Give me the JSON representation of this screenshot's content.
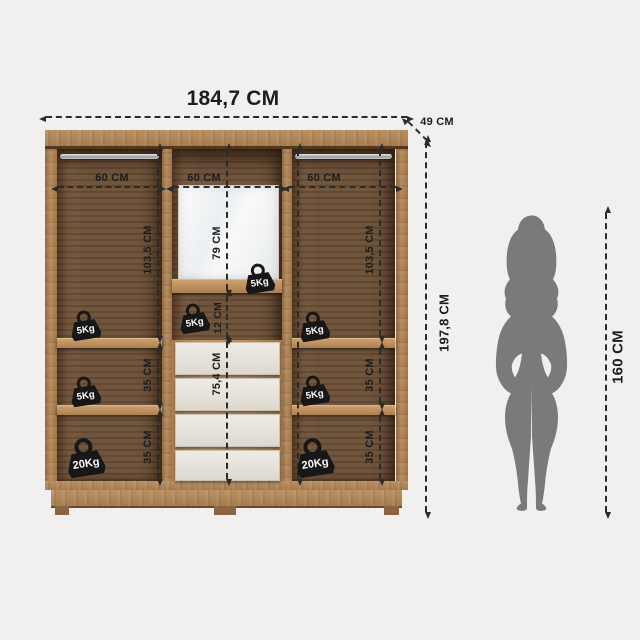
{
  "overall": {
    "width_label": "184,7 CM",
    "depth_label": "49 CM",
    "height_label": "197,8 CM",
    "person_height_label": "160 CM"
  },
  "sections": {
    "left": {
      "width_label": "60 CM",
      "top_height_label": "103,5 CM",
      "mid_height_label": "35 CM",
      "bottom_height_label": "35 CM",
      "badge_top": "5Kg",
      "badge_mid": "5Kg",
      "badge_bottom": "20Kg"
    },
    "middle": {
      "width_label": "60 CM",
      "mirror_height_label": "79 CM",
      "badge_mirror": "5Kg",
      "gap_height_label": "12 CM",
      "badge_gap": "5Kg",
      "drawers_height_label": "75,4 CM",
      "drawer_count": 4
    },
    "right": {
      "width_label": "60 CM",
      "top_height_label": "103,5 CM",
      "mid_height_label": "35 CM",
      "bottom_height_label": "35 CM",
      "badge_top": "5Kg",
      "badge_mid": "5Kg",
      "badge_bottom": "20Kg"
    }
  },
  "colors": {
    "background": "#f2f0ee",
    "wood": "#b2885a",
    "wood_dark": "#6c5037",
    "dimension_line": "#2b2b2b",
    "badge": "#171717",
    "badge_text": "#ffffff",
    "drawer_front": "#e8e4dd",
    "mirror": "#f3f5f6",
    "silhouette": "#7a7a7a"
  }
}
